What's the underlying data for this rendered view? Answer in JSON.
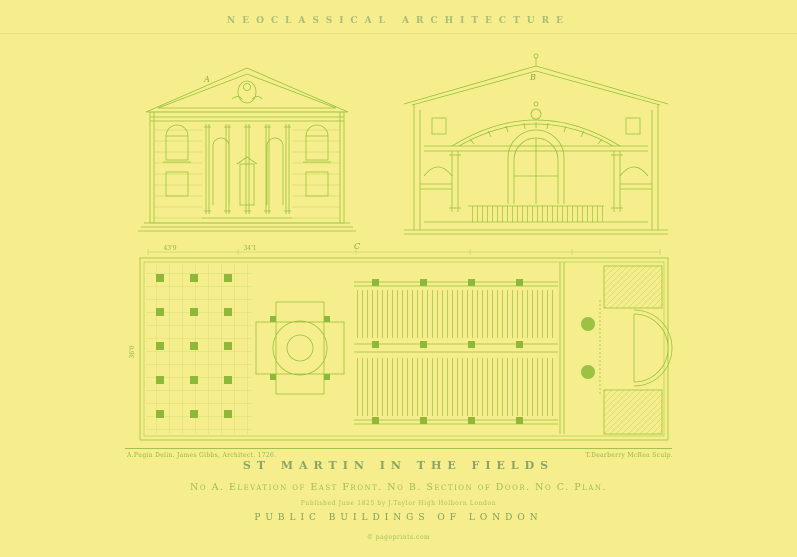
{
  "header": {
    "series_title": "NEOCLASSICAL ARCHITECTURE"
  },
  "plate": {
    "figure_labels": {
      "a": "A",
      "b": "B",
      "c": "C"
    },
    "dimensions": {
      "left": "43'9",
      "right": "34'1",
      "side": "36'0"
    },
    "credit_left": "A.Pugin Delin. James Gibbs, Architect. 1726.",
    "credit_right": "T.Dearberry McRea Sculp."
  },
  "footer": {
    "title": "ST MARTIN IN THE FIELDS",
    "subtitle": "No A. Elevation of East Front. No B. Section of Door. No C. Plan.",
    "publication_line": "Published June 1825 by J.Taylor High Holborn London",
    "series": "PUBLIC BUILDINGS OF LONDON",
    "copyright": "© pageprints.com"
  },
  "colors": {
    "background": "#f6ee8d",
    "ink": "#96c13b",
    "solid_ink": "#8db838",
    "text_muted": "#9aae72"
  }
}
